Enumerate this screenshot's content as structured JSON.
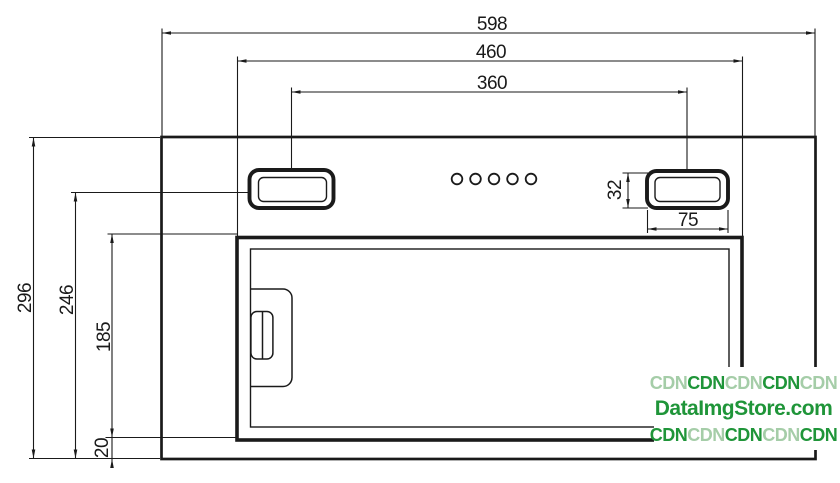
{
  "diagram": {
    "title": "built-in-hood-front-view-dimension-drawing",
    "ink_color": "#1a1a1a",
    "labels": {
      "top_width": "598",
      "mid_width": "460",
      "slot_span": "360",
      "total_height": "296",
      "slot_center_height": "246",
      "filter_height": "185",
      "bottom_gap": "20",
      "slot_height": "32",
      "slot_width": "75"
    }
  },
  "watermark": {
    "line1": [
      {
        "text": "CDN",
        "tone": "light"
      },
      {
        "text": "CDN",
        "tone": "dark"
      },
      {
        "text": "CDN",
        "tone": "light"
      },
      {
        "text": "CDN",
        "tone": "dark"
      },
      {
        "text": "CDN",
        "tone": "light"
      }
    ],
    "line2": "DataImgStore.com",
    "line3": [
      {
        "text": "CDN",
        "tone": "dark"
      },
      {
        "text": "CDN",
        "tone": "light"
      },
      {
        "text": "CDN",
        "tone": "dark"
      },
      {
        "text": "CDN",
        "tone": "light"
      },
      {
        "text": "CDN",
        "tone": "dark"
      }
    ],
    "colors": {
      "dark": "#1f9539",
      "light": "#a5cda8"
    }
  }
}
